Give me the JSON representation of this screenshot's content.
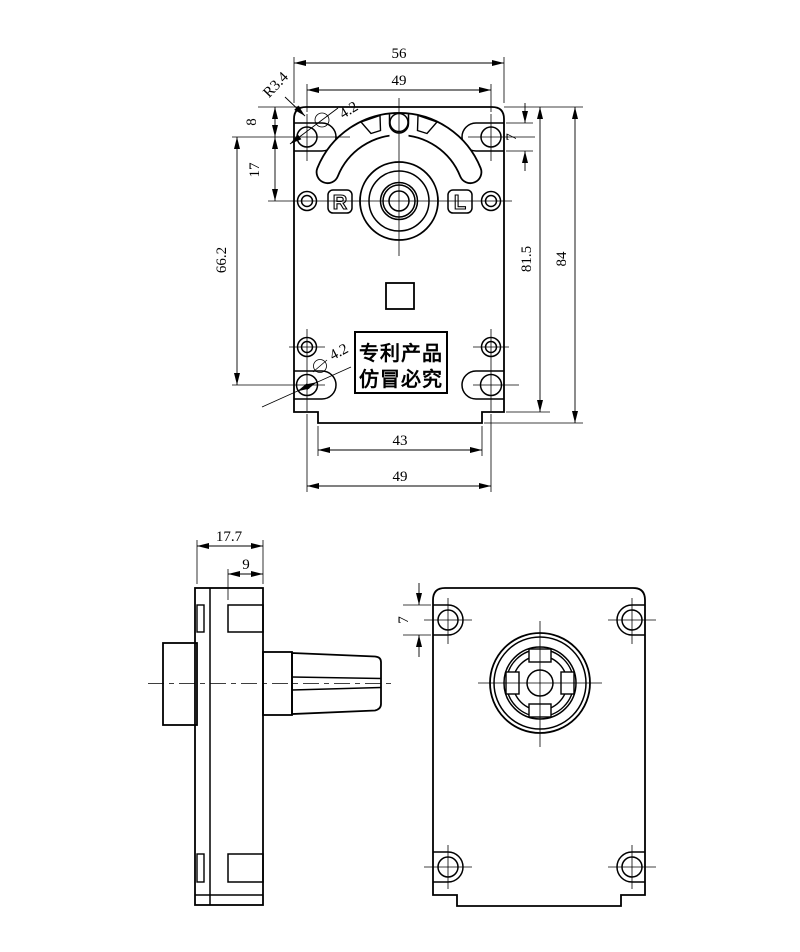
{
  "title": "Gear motor engineering drawing",
  "colors": {
    "line": "#000000",
    "background": "#ffffff"
  },
  "front": {
    "dim_width_top": "56",
    "dim_hole_span_top": "49",
    "dim_corner_radius": "R3.4",
    "dim_hole_dia_top": "4.2",
    "dim_edge_to_hole": "8",
    "dim_hole_pitch": "17",
    "dim_slot_height": "7",
    "dim_hole_span_side": "66.2",
    "dim_height_body": "81.5",
    "dim_height_total": "84",
    "dim_step_width": "43",
    "dim_hole_span_bottom": "49",
    "dim_hole_dia_bottom": "4.2",
    "label_r": "R",
    "label_l": "L",
    "patent_line1": "专利产品",
    "patent_line2": "仿冒必究"
  },
  "side": {
    "dim_depth_total": "17.7",
    "dim_depth_front": "9"
  },
  "rear": {
    "dim_slot_height": "7"
  }
}
